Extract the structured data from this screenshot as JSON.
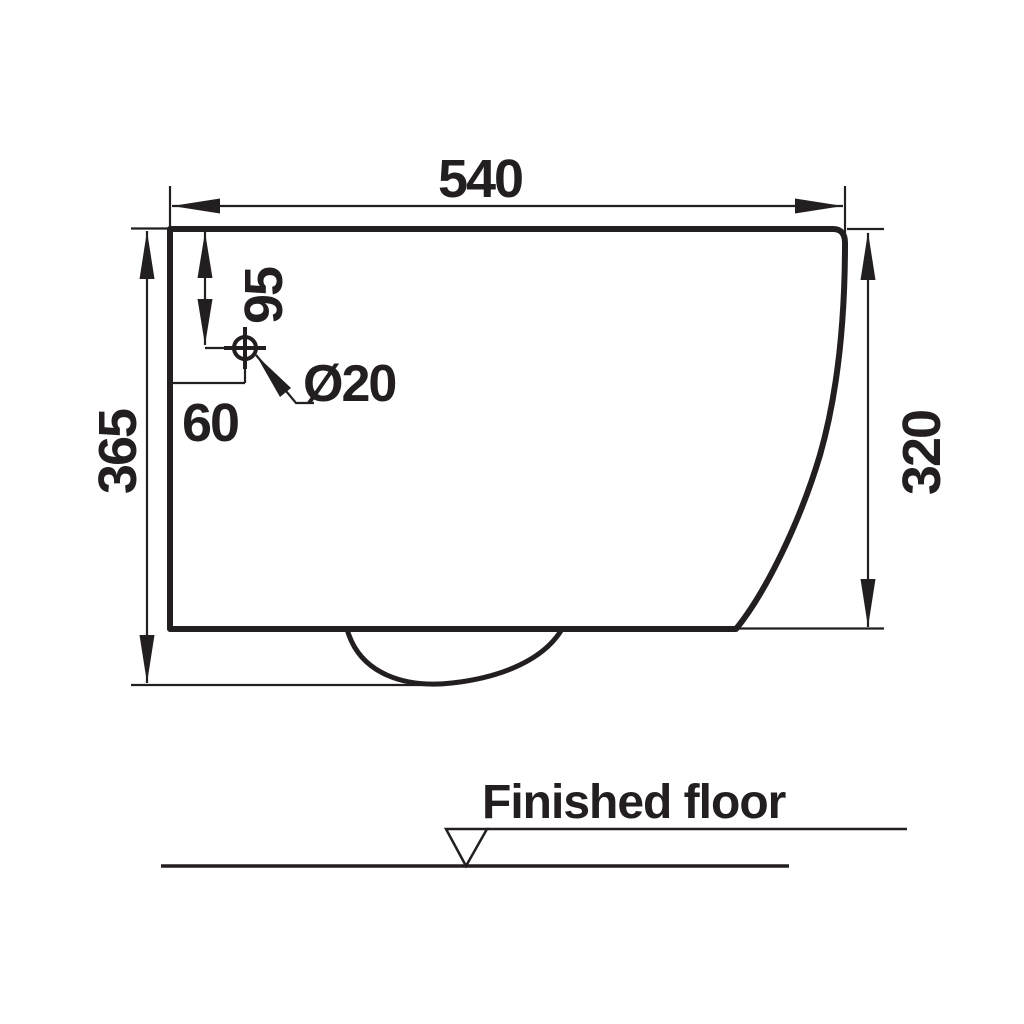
{
  "colors": {
    "ink": "#231f20",
    "background": "#ffffff"
  },
  "dimensions": {
    "overall_width": "540",
    "overall_height": "365",
    "front_height": "320",
    "hole_top_offset": "95",
    "hole_side_offset": "60",
    "hole_diameter": "Ø20"
  },
  "labels": {
    "floor": "Finished floor"
  }
}
